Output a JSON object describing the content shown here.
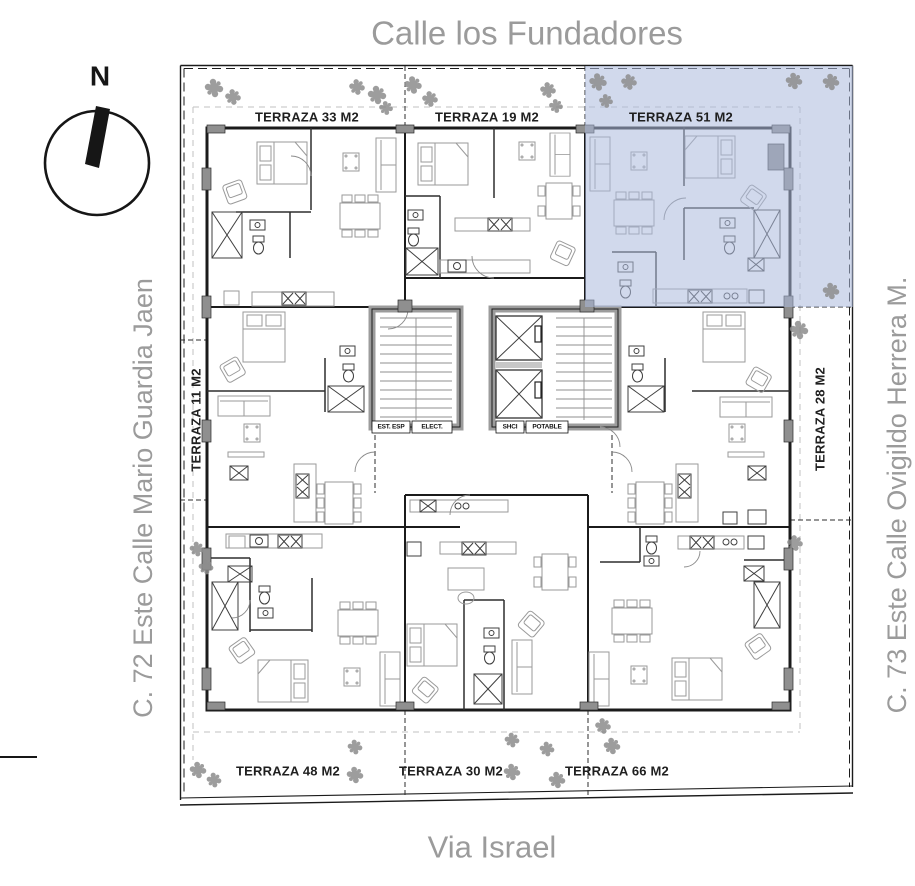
{
  "streets": {
    "top": "Calle los Fundadores",
    "bottom": "Via Israel",
    "left": "C. 72 Este Calle Mario Guardia Jaen",
    "right": "C. 73 Este Calle Ovigildo Herrera M."
  },
  "compass": {
    "north_label": "N"
  },
  "terraces": {
    "t33": "TERRAZA 33 M2",
    "t19": "TERRAZA 19 M2",
    "t51": "TERRAZA 51 M2",
    "t11": "TERRAZA 11 M2",
    "t28": "TERRAZA 28 M2",
    "t48": "TERRAZA 48 M2",
    "t30": "TERRAZA 30 M2",
    "t66": "TERRAZA 66 M2"
  },
  "core_labels": {
    "est_esp": "EST. ESP",
    "elect": "ELECT.",
    "shci": "SHCI",
    "potable": "POTABLE"
  },
  "highlight": {
    "selected_terrace": "TERRAZA 51 M2",
    "color": "#abb9dc"
  },
  "colors": {
    "highlight": "#abb9dc",
    "street": "#9b9b9b",
    "tree": "#8d8d8d",
    "wall": "#1b1b1b",
    "furn": "#9a9a9a",
    "corewall": "#9c9c9c"
  }
}
